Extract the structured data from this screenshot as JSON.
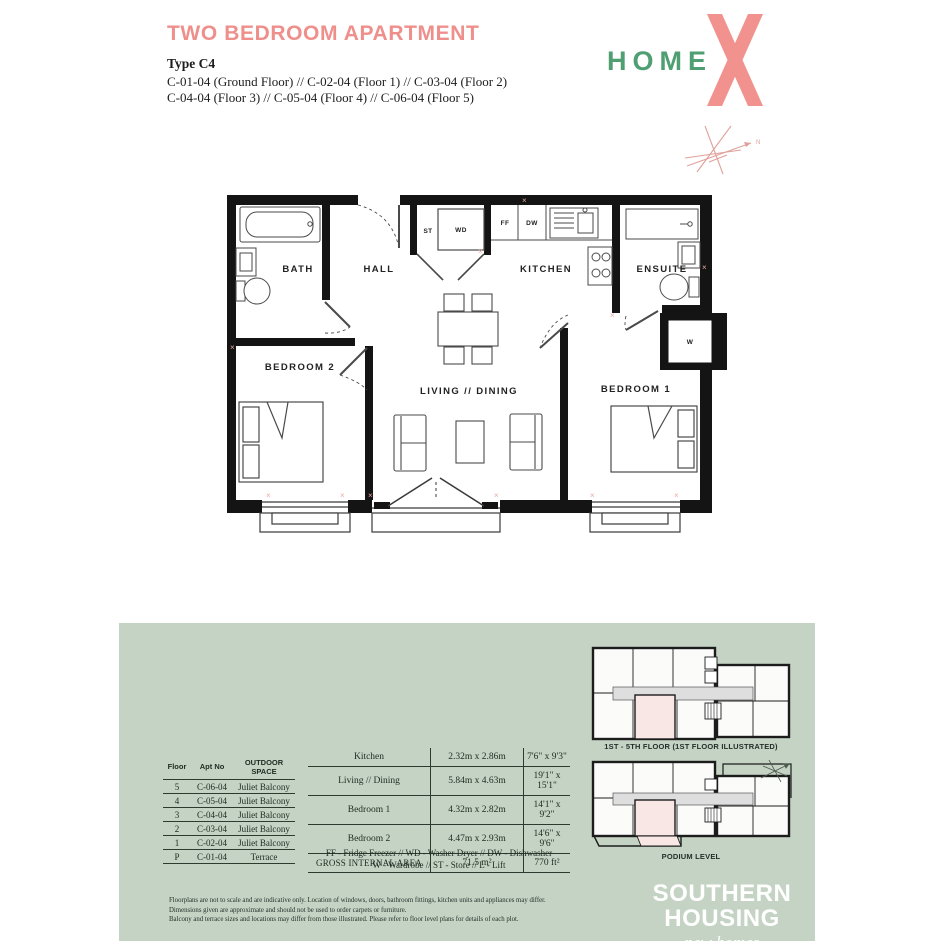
{
  "colors": {
    "accent_pink": "#ef8f8b",
    "logo_green": "#4f9f72",
    "panel_green": "#c4d3c3",
    "highlight_pink": "#f9e7e5",
    "compass_pink": "#dfa09a"
  },
  "header": {
    "title": "TWO BEDROOM APARTMENT",
    "type_label": "Type C4",
    "apartments_line1": "C-01-04 (Ground Floor) // C-02-04 (Floor 1) // C-03-04 (Floor 2)",
    "apartments_line2": "C-04-04 (Floor 3) // C-05-04 (Floor 4) // C-06-04 (Floor 5)",
    "logo_text": "HOME"
  },
  "floorplan": {
    "rooms": {
      "bath": "BATH",
      "hall": "HALL",
      "kitchen": "KITCHEN",
      "ensuite": "ENSUITE",
      "bedroom2": "BEDROOM 2",
      "living": "LIVING // DINING",
      "bedroom1": "BEDROOM 1"
    },
    "labels": {
      "st": "ST",
      "wd": "WD",
      "ff": "FF",
      "dw": "DW",
      "w": "W"
    }
  },
  "floor_table": {
    "headers": [
      "Floor",
      "Apt No",
      "OUTDOOR SPACE"
    ],
    "rows": [
      [
        "5",
        "C-06-04",
        "Juliet Balcony"
      ],
      [
        "4",
        "C-05-04",
        "Juliet Balcony"
      ],
      [
        "3",
        "C-04-04",
        "Juliet Balcony"
      ],
      [
        "2",
        "C-03-04",
        "Juliet Balcony"
      ],
      [
        "1",
        "C-02-04",
        "Juliet Balcony"
      ],
      [
        "P",
        "C-01-04",
        "Terrace"
      ]
    ]
  },
  "dimensions_table": {
    "rows": [
      [
        "Kitchen",
        "2.32m x 2.86m",
        "7'6\" x 9'3\""
      ],
      [
        "Living // Dining",
        "5.84m x 4.63m",
        "19'1\" x 15'1\""
      ],
      [
        "Bedroom 1",
        "4.32m x 2.82m",
        "14'1\" x 9'2\""
      ],
      [
        "Bedroom 2",
        "4.47m x 2.93m",
        "14'6\" x 9'6\""
      ],
      [
        "GROSS INTERNAL AREA",
        "71.5 m²",
        "770 ft²"
      ]
    ],
    "legend_line1": "FF - Fridge Freezer  //  WD - Washer Dryer  //  DW - Dishwasher",
    "legend_line2": "W - Wardrobe  //  ST - Store  //  L - Lift"
  },
  "key_plans": {
    "upper_caption": "1ST - 5TH FLOOR (1ST FLOOR ILLUSTRATED)",
    "lower_caption": "PODIUM LEVEL"
  },
  "footer": {
    "disclaimer_line1": "Floorplans are not to scale and are indicative only. Location of windows, doors, bathroom fittings, kitchen units and appliances may differ.",
    "disclaimer_line2": "Dimensions given are approximate and should not be used to order carpets or furniture.",
    "disclaimer_line3": "Balcony and terrace sizes and locations may differ from those illustrated. Please refer to floor level plans for details of each plot.",
    "brand_line1": "SOUTHERN",
    "brand_line2": "HOUSING",
    "brand_tagline": "new homes"
  }
}
